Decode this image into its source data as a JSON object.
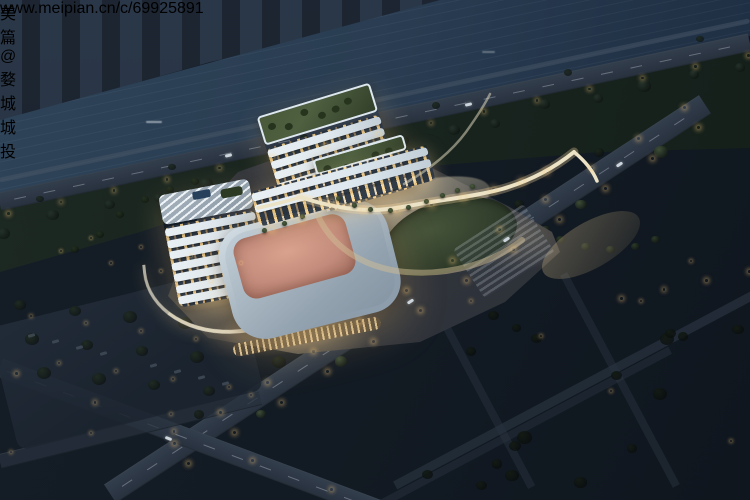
{
  "scene": {
    "subject": "Aerial night rendering of a riverside cultural and sports complex",
    "elements": [
      "river with far bank skyline",
      "riverside road",
      "office tower",
      "sports hall with pink roof",
      "terraced slab buildings with roof gardens",
      "organic-shaped building with rooftop pool",
      "central lawn plaza with palm promenade",
      "tree-lined boulevard",
      "dark residential blocks"
    ]
  },
  "watermark": {
    "logo_icon": "meipian-logo",
    "brand": "美篇 @婺城城投",
    "url": "www.meipian.cn/c/69925891"
  },
  "palette": {
    "far_bank": "#1c2632",
    "river": "#2a3d52",
    "park": "#18231e",
    "road": "#2c3644",
    "facade": "#dde7ee",
    "window_warm": "#ffd89a",
    "glow": "#f2d9a8",
    "roof_pink": "#c28b7b",
    "roof_green": "#4e6040",
    "pool_blue": "#7cc0d6",
    "residential": "#27303c",
    "watermark_text": "#e9e9e9"
  }
}
